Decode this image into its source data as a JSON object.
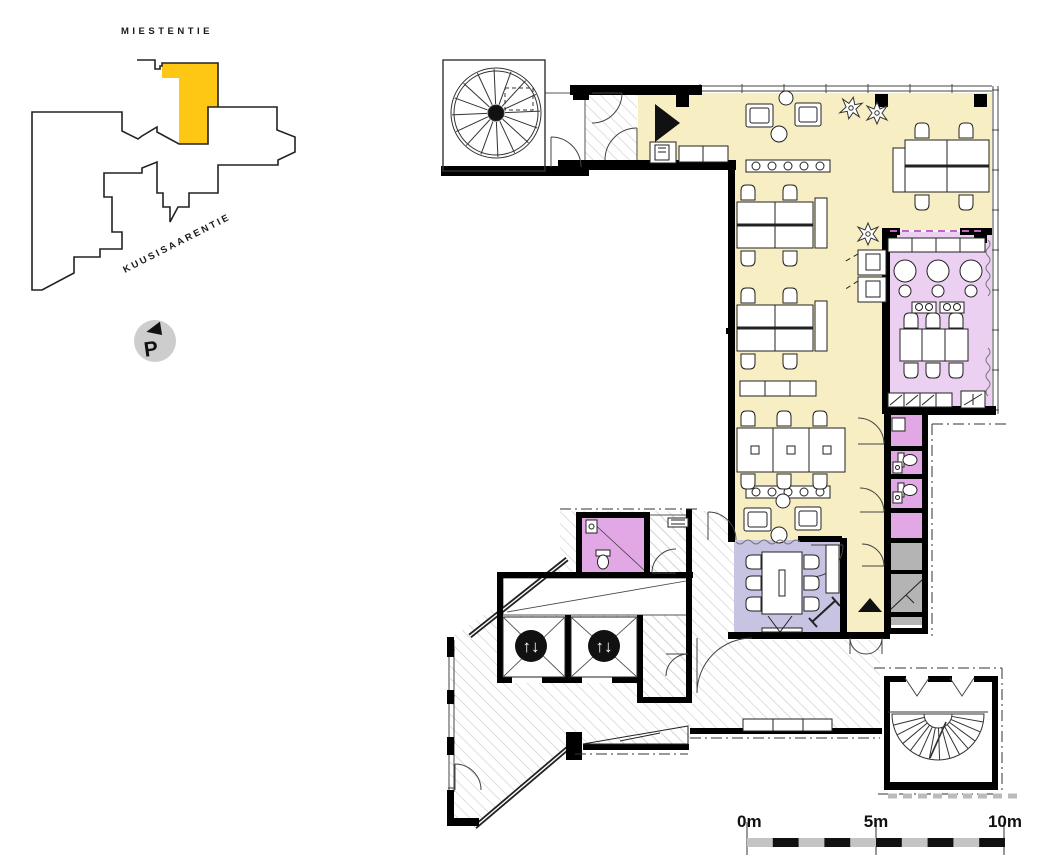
{
  "site_map": {
    "street_top_label": "MIESTENTIE",
    "street_diagonal_label": "KUUSISAARENTIE",
    "highlight_color": "#FDC713",
    "parking_badge": {
      "label": "P",
      "circle_color": "#CDCDCD"
    }
  },
  "floor_plan": {
    "elevator_icon_glyph": "↑↓",
    "colors": {
      "open_office": "#F7EEC3",
      "cafe": "#EBD0F1",
      "wc": "#E1A8E5",
      "meeting_room": "#C7C3E3",
      "service": "#B4B4B4",
      "wall": "#000000",
      "hatch_line": "#C9C9C9"
    }
  },
  "scale_bar": {
    "label_0": "0m",
    "label_5": "5m",
    "label_10": "10m"
  }
}
